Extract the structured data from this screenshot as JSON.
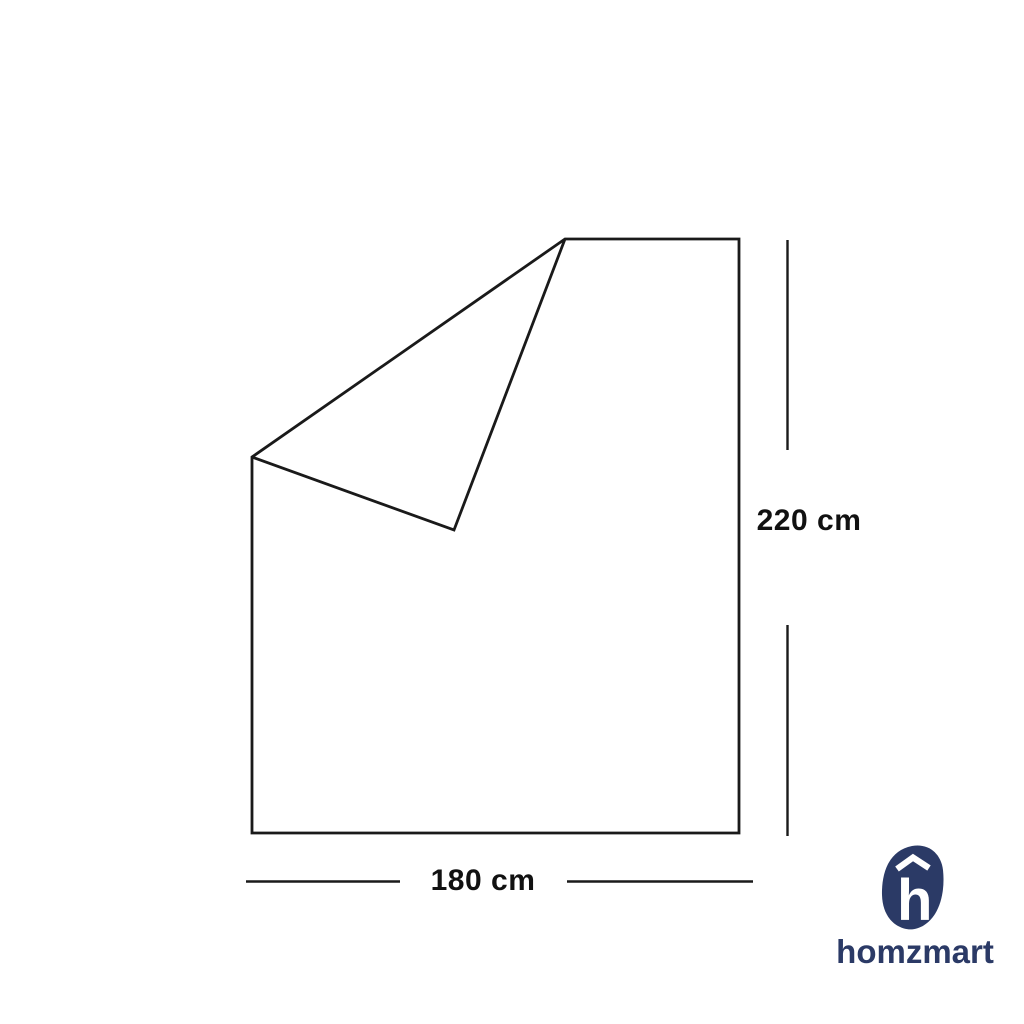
{
  "page": {
    "background_color": "#ffffff"
  },
  "diagram": {
    "kind": "product-dimension-outline",
    "height_label": "220 cm",
    "width_label": "180 cm",
    "line_color": "#1a1a1a",
    "label_color": "#111111"
  },
  "logo": {
    "wordmark": "homzmart",
    "brand_color": "#2b3a66",
    "icon": "h-blob-with-roof-icon"
  }
}
